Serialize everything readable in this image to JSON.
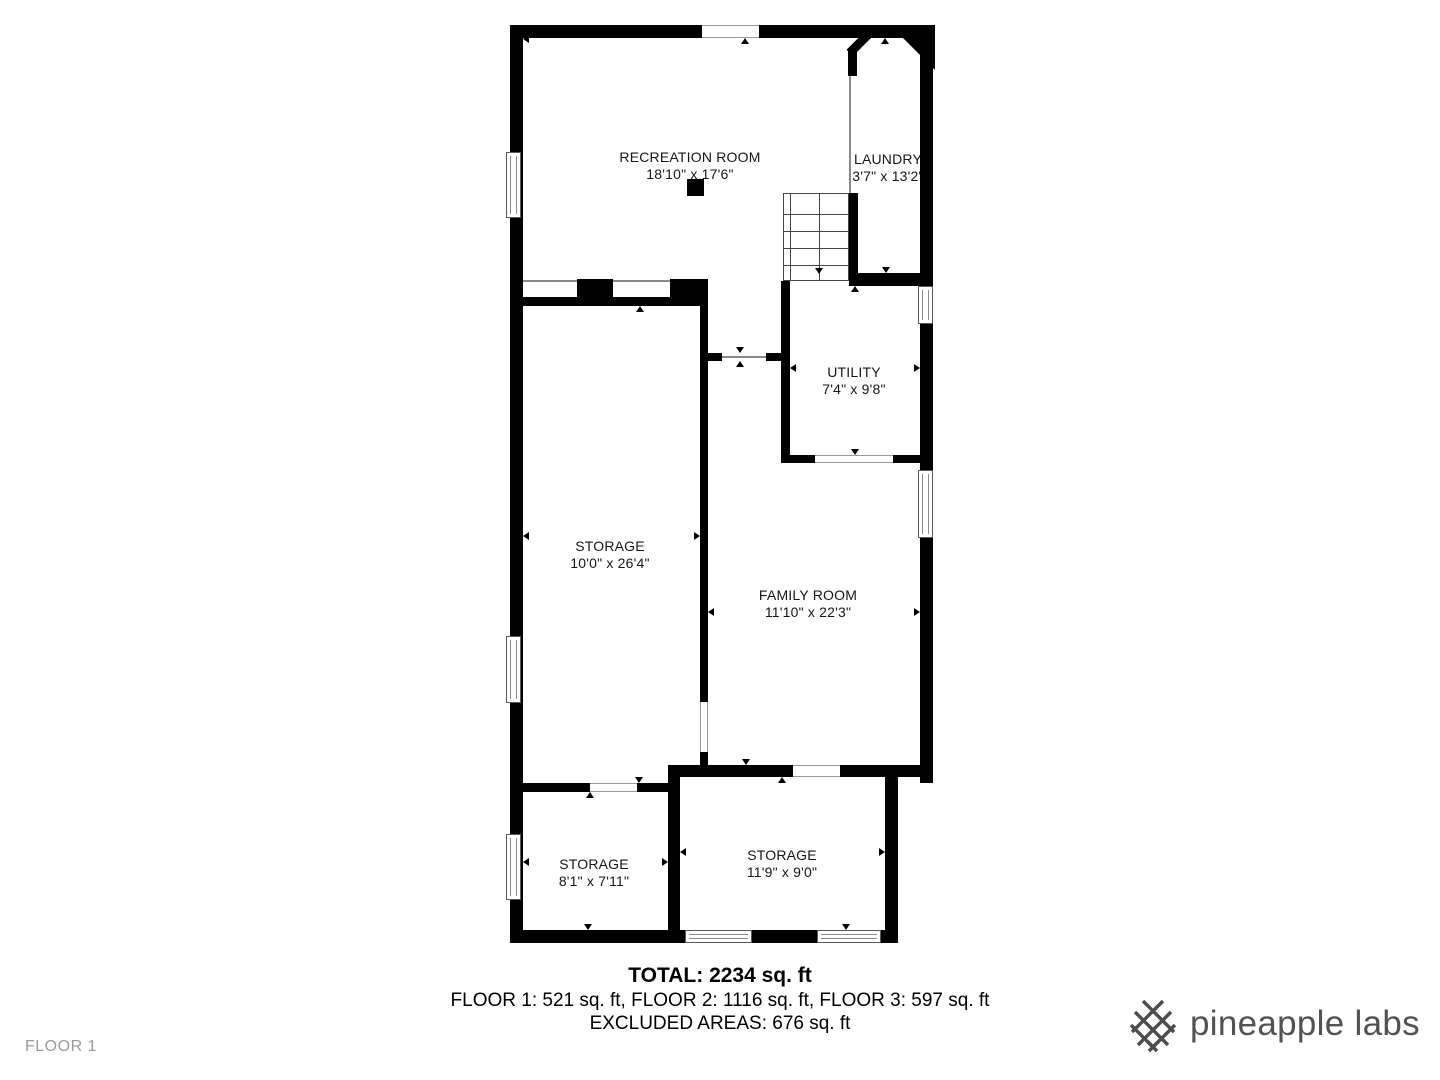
{
  "floor_plan": {
    "floor_label": "FLOOR 1",
    "rooms": [
      {
        "name": "RECREATION ROOM",
        "dims": "18'10\" x 17'6\""
      },
      {
        "name": "LAUNDRY",
        "dims": "3'7\" x 13'2\""
      },
      {
        "name": "UTILITY",
        "dims": "7'4\" x 9'8\""
      },
      {
        "name": "STORAGE",
        "dims": "10'0\" x 26'4\""
      },
      {
        "name": "FAMILY ROOM",
        "dims": "11'10\" x 22'3\""
      },
      {
        "name": "STORAGE",
        "dims": "8'1\" x 7'11\""
      },
      {
        "name": "STORAGE",
        "dims": "11'9\" x 9'0\""
      }
    ],
    "features": [
      "staircase-with-down-arrow",
      "wall-windows",
      "door-openings",
      "support-column"
    ]
  },
  "summary": {
    "total": "TOTAL: 2234 sq. ft",
    "floors": "FLOOR 1: 521 sq. ft, FLOOR 2: 1116 sq. ft, FLOOR 3: 597 sq. ft",
    "excluded": "EXCLUDED AREAS: 676 sq. ft"
  },
  "brand": {
    "name": "pineapple labs",
    "icon": "lattice-icon"
  },
  "colors": {
    "wall": "#000000",
    "muted_text": "#9b9b9b",
    "brand_text": "#525252"
  }
}
